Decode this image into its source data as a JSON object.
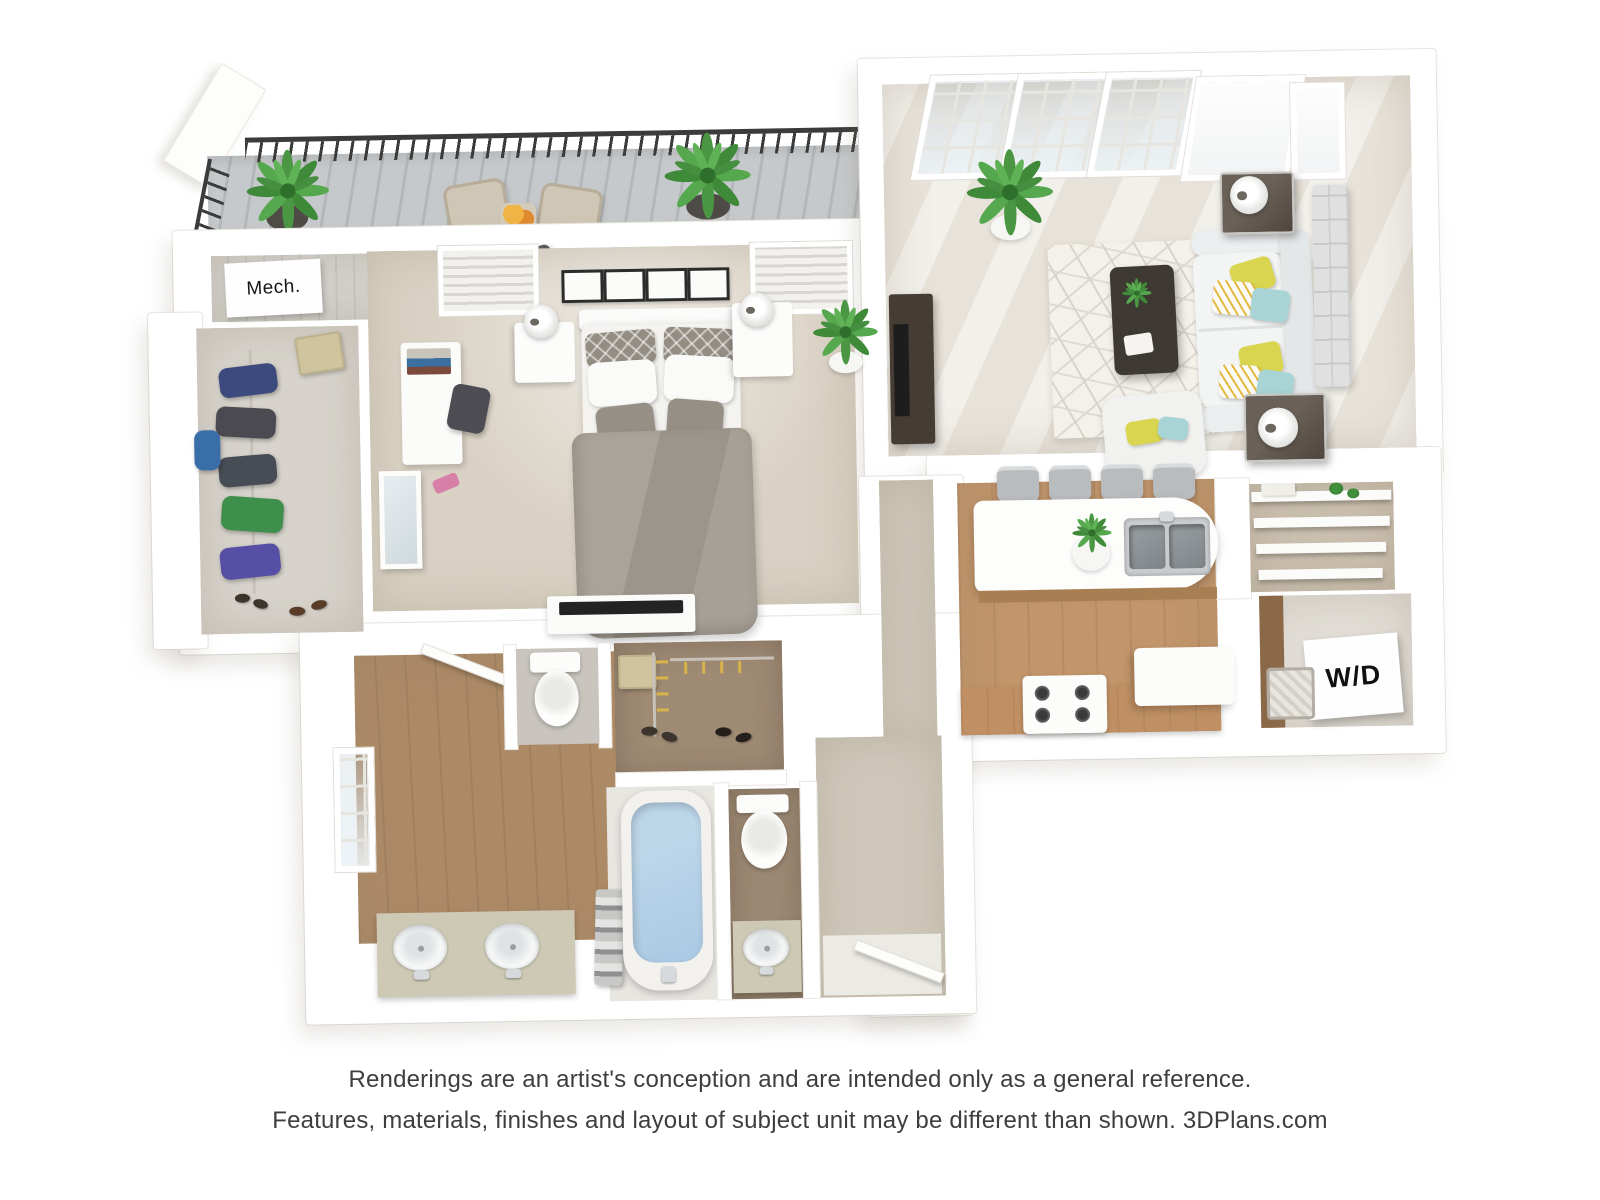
{
  "title": "3D apartment floor plan rendering",
  "plan": {
    "room_labels": {
      "mech": "Mech.",
      "washer_dryer": "W/D"
    }
  },
  "disclaimer": {
    "line1": "Renderings are an artist's conception and are intended only as a general reference.",
    "line2": "Features, materials, finishes and layout of subject unit may be different than shown. 3DPlans.com"
  },
  "colors": {
    "wall": "#ffffff",
    "wall-edge": "#e9e6e0",
    "carpet": "#d9d1c3",
    "living-floor": "#e8e3da",
    "wood": "#c2956a",
    "wood-dark": "#a87f52",
    "bath-wood": "#ad8a66",
    "closet-floor": "#d7d3cc",
    "deck": "#c6c9cb",
    "deck-line": "#b4b7b9",
    "railing": "#3b3b3b",
    "duvet": "#a39c92",
    "yellow": "#d9d54f",
    "teal": "#a8d4d6",
    "tub": "#aac9e3",
    "sage": "#cdc9b5",
    "dark-wood": "#453c33",
    "beige-hall": "#cfc8ba",
    "text": "#3e3e3e"
  }
}
